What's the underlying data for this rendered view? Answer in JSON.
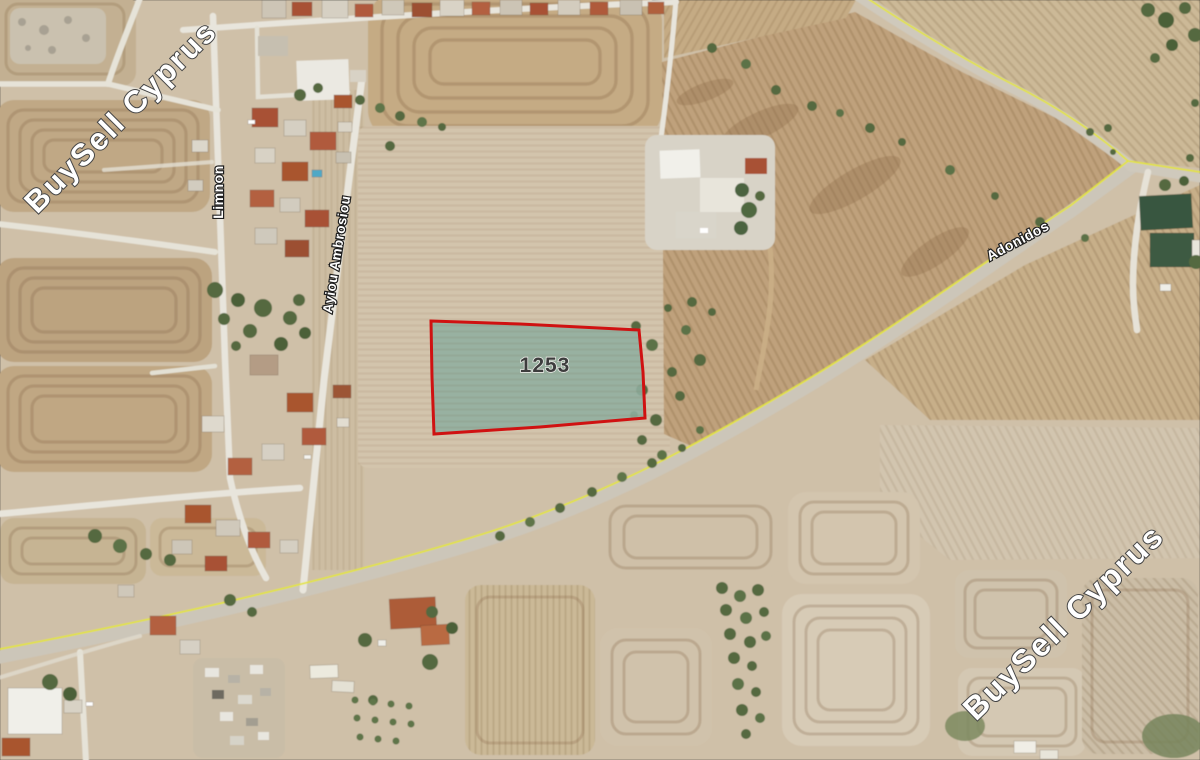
{
  "map": {
    "parcel": {
      "label": "1253"
    },
    "streets": {
      "limnon": "Limnon",
      "ayiou": "Ayiou Ambrosiou",
      "adonidos": "Adonidos"
    },
    "watermark": {
      "text": "BuySell Cyprus"
    },
    "colors": {
      "parcel_fill": "#8fae9f",
      "parcel_outline": "#d01111",
      "road_line_yellow": "#e3e33c"
    }
  }
}
